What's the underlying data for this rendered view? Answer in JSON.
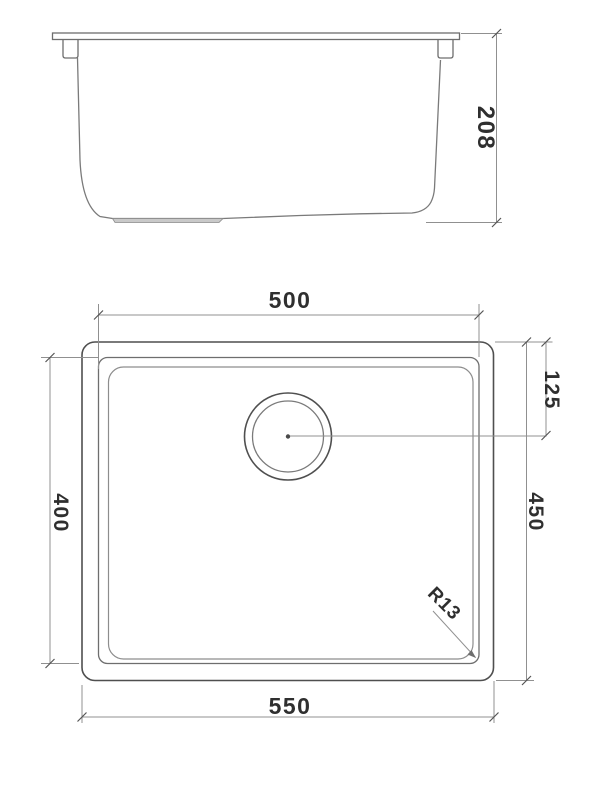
{
  "dimensions": {
    "side_height": "208",
    "bowl_width": "500",
    "bowl_front_to_back": "400",
    "overall_width": "550",
    "overall_front_to_back": "450",
    "drain_center_offset": "125",
    "bowl_corner_radius": "R13"
  },
  "colors": {
    "background": "#ffffff",
    "line_dark": "#4f4f4f",
    "line_medium": "#6e6e6e",
    "line_light": "#8d8d8d",
    "dimension_line": "#909090",
    "text": "#2f2f2f",
    "drain_boss_fill": "#c9c9c9"
  }
}
